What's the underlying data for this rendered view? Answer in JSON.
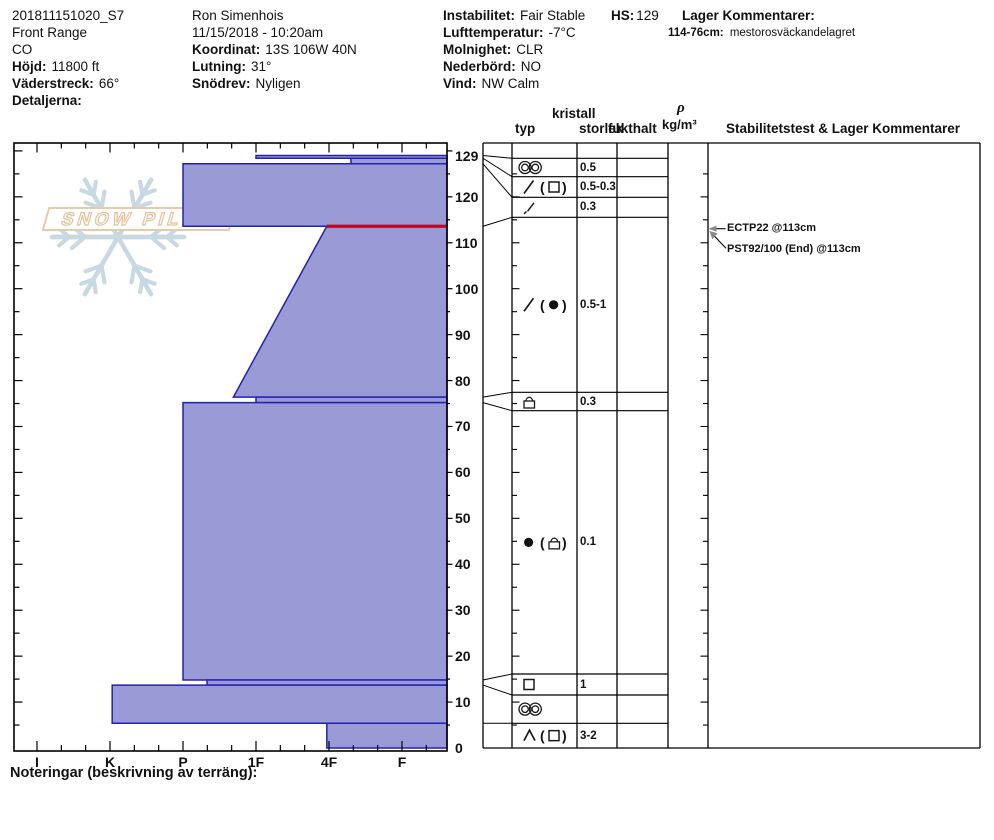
{
  "header": {
    "col1": {
      "id": "201811151020_S7",
      "area": "Front Range",
      "state": "CO",
      "hojd_label": "Höjd:",
      "hojd_value": "11800 ft",
      "vaderstreck_label": "Väderstreck:",
      "vaderstreck_value": "66°",
      "detaljerna_label": "Detaljerna:"
    },
    "col2": {
      "observer": "Ron Simenhois",
      "datetime": "11/15/2018 - 10:20am",
      "koordinat_label": "Koordinat:",
      "koordinat_value": "13S 106W 40N",
      "lutning_label": "Lutning:",
      "lutning_value": "31°",
      "snodrev_label": "Snödrev:",
      "snodrev_value": "Nyligen"
    },
    "col3": {
      "instabilitet_label": "Instabilitet:",
      "instabilitet_value": "Fair Stable",
      "lufttemperatur_label": "Lufttemperatur:",
      "lufttemperatur_value": "-7°C",
      "molnighet_label": "Molnighet:",
      "molnighet_value": "CLR",
      "nederbord_label": "Nederbörd:",
      "nederbord_value": "NO",
      "vind_label": "Vind:",
      "vind_value": "NW Calm"
    },
    "hs_label": "HS:",
    "hs_value": "129",
    "lager_heading": "Lager Kommentarer:",
    "comment_range": "114-76cm:",
    "comment_text": "mestorosväckandelagret"
  },
  "logo": {
    "text": "SNOW PILOT"
  },
  "chart_data": {
    "type": "bar",
    "title": "Snow profile hardness vs depth",
    "xlabel": "hand hardness",
    "ylabel": "depth (cm)",
    "hardness_categories": [
      "I",
      "K",
      "P",
      "1F",
      "4F",
      "F"
    ],
    "depth_ticks": [
      129,
      120,
      110,
      100,
      90,
      80,
      70,
      60,
      50,
      40,
      30,
      20,
      10,
      0
    ],
    "hs_cm": 129,
    "ylim": [
      0,
      132
    ],
    "layers": [
      {
        "top_cm": 129,
        "bottom_cm": 128.4,
        "hardness": "1F",
        "hard_top_idx": 3.0,
        "hard_bottom_idx": 3.0
      },
      {
        "top_cm": 128.4,
        "bottom_cm": 127.2,
        "hardness": "4F-F",
        "hard_top_idx": 4.3,
        "hard_bottom_idx": 4.3
      },
      {
        "top_cm": 127.2,
        "bottom_cm": 113.6,
        "hardness": "P",
        "hard_top_idx": 2.0,
        "hard_bottom_idx": 2.0
      },
      {
        "top_cm": 113.6,
        "bottom_cm": 76.4,
        "hardness": "4F to 1F+",
        "hard_top_idx": 3.97,
        "hard_bottom_idx": 2.69
      },
      {
        "top_cm": 76.4,
        "bottom_cm": 75.2,
        "hardness": "1F",
        "hard_top_idx": 3.0,
        "hard_bottom_idx": 3.0
      },
      {
        "top_cm": 75.2,
        "bottom_cm": 14.8,
        "hardness": "P",
        "hard_top_idx": 2.0,
        "hard_bottom_idx": 2.0
      },
      {
        "top_cm": 14.8,
        "bottom_cm": 13.7,
        "hardness": "P-",
        "hard_top_idx": 2.33,
        "hard_bottom_idx": 2.33
      },
      {
        "top_cm": 13.7,
        "bottom_cm": 5.4,
        "hardness": "K",
        "hard_top_idx": 1.03,
        "hard_bottom_idx": 1.03
      },
      {
        "top_cm": 5.4,
        "bottom_cm": 0,
        "hardness": "4F",
        "hard_top_idx": 3.97,
        "hard_bottom_idx": 3.97
      }
    ],
    "failure_line_cm": 113.6,
    "legend": "none",
    "grid": "off"
  },
  "profile_table": {
    "headers": {
      "kristall": "kristall",
      "typ": "typ",
      "storlek": "storlek",
      "fukthalt": "fukthalt",
      "rho": "ρ",
      "rho_unit": "kg/m³",
      "stability": "Stabilitetstest & Lager Kommentarer"
    },
    "rows": [
      {
        "symbol": "rings",
        "paren": null,
        "storlek": "0.5",
        "fukthalt": ""
      },
      {
        "symbol": "slash",
        "paren": "square",
        "storlek": "0.5-0.3",
        "fukthalt": ""
      },
      {
        "symbol": "slash-small",
        "paren": null,
        "storlek": "0.3",
        "fukthalt": ""
      },
      {
        "symbol": "slash",
        "paren": "dot",
        "storlek": "0.5-1",
        "fukthalt": ""
      },
      {
        "symbol": "crust",
        "paren": null,
        "storlek": "0.3",
        "fukthalt": ""
      },
      {
        "symbol": "dot",
        "paren": "crust",
        "storlek": "0.1",
        "fukthalt": ""
      },
      {
        "symbol": "square",
        "paren": null,
        "storlek": "1",
        "fukthalt": ""
      },
      {
        "symbol": "rings",
        "paren": null,
        "storlek": "",
        "fukthalt": ""
      },
      {
        "symbol": "caret",
        "paren": "square",
        "storlek": "3-2",
        "fukthalt": ""
      }
    ],
    "tests": [
      {
        "label": "ECTP22 @113cm",
        "depth_cm": 113
      },
      {
        "label": "PST92/100 (End) @113cm",
        "depth_cm": 113
      }
    ]
  },
  "footer": {
    "noteringar_label": "Noteringar (beskrivning av terräng):"
  },
  "colors": {
    "bar_fill": "#9a9ad6",
    "bar_border": "#2222b2",
    "failure": "#c00a20",
    "line": "#000000",
    "arrow_head": "#8a8a8a",
    "logo_flake": "#c9d9e3",
    "logo_banner": "#e8caa6"
  }
}
